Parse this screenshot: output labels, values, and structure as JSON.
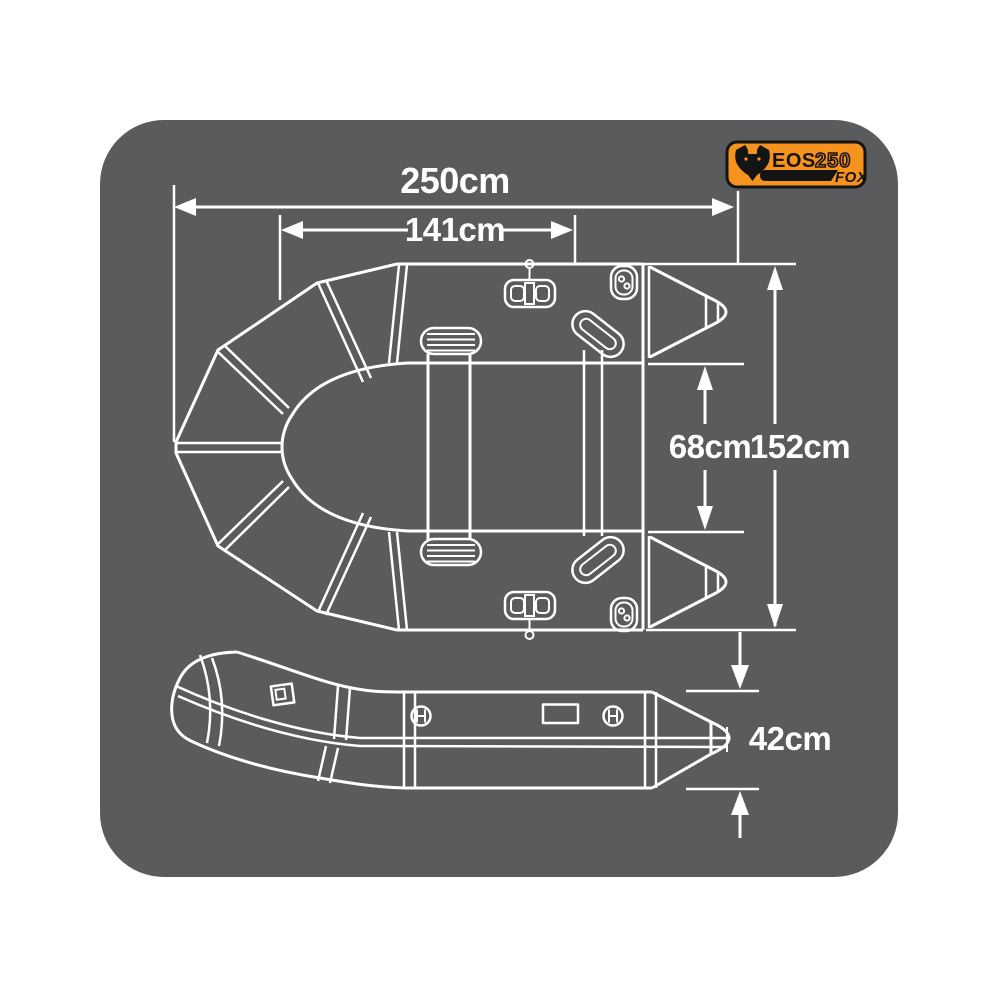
{
  "badge": {
    "model": "EOS",
    "size": "250",
    "brand": "FOX",
    "icon": "fox-head-icon"
  },
  "dimensions": {
    "overall_length": "250cm",
    "inner_length": "141cm",
    "inner_width": "68cm",
    "overall_width": "152cm",
    "tube_height": "42cm"
  },
  "colors": {
    "panel_background": "#5A5B5D",
    "line": "#FFFFFF",
    "brand_orange": "#F6921E",
    "badge_ink": "#141414"
  }
}
